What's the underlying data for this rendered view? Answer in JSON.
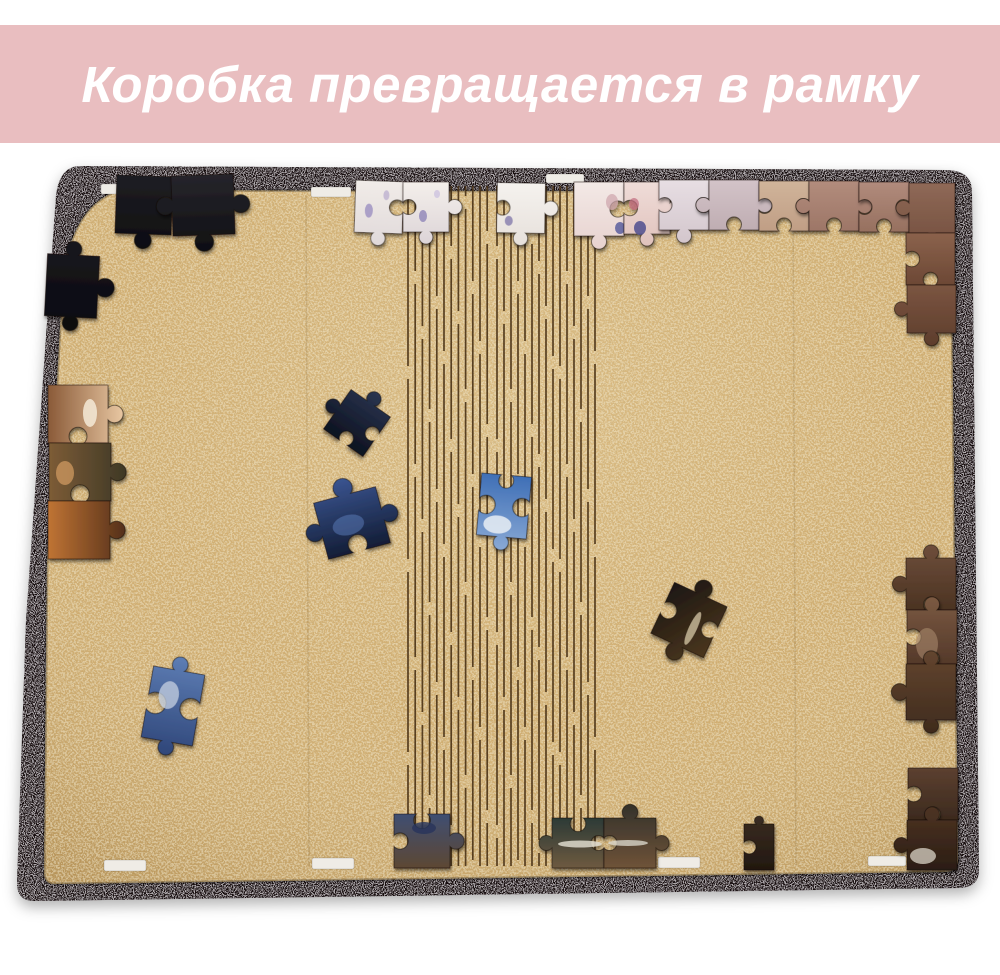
{
  "banner": {
    "text": "Коробка превращается в рамку",
    "bg_color": "#e9bec0",
    "text_color": "#ffffff"
  },
  "photo": {
    "frame": {
      "outer_path": "M 80 166 L 948 170 Q 972 171 972 192 L 979 868 Q 980 887 960 888 L 36 901 Q 17 902 17 883 L 26 620 L 56 195 Q 60 166 80 166 Z",
      "inner_path": "M 120 190 L 934 192 Q 951 193 951 207 L 958 860 Q 958 871 946 872 L 56 884 Q 44 885 44 872 L 47 560 L 62 292 Q 68 206 120 190 Z",
      "base_color": "#170e11",
      "speckle_color": "#9a9398",
      "edge_shadow": "rgba(0,0,0,0.25)"
    },
    "board": {
      "base_color": "#cfab6d",
      "speckle_light": "#eeddab",
      "speckle_dark": "#93713b",
      "glow_center": "#f7e7bd",
      "shade_edge": "#7a5620",
      "crease_xs": [
        306,
        793
      ]
    },
    "hinge": {
      "color": "#4a3216",
      "line_width": 1.7,
      "opacity": 0.9,
      "y_top": 186,
      "y_bottom": 866,
      "dash": "180 13",
      "offsets": [
        0,
        95,
        40,
        150,
        70,
        15,
        120,
        55,
        170,
        85,
        25,
        135,
        105,
        60,
        10
      ],
      "columns": [
        {
          "x_start": 408,
          "count": 12,
          "spacing": 7.2
        },
        {
          "x_start": 497,
          "count": 15,
          "spacing": 7.0
        }
      ]
    },
    "slots": {
      "color": "#efece6",
      "items": [
        {
          "x": 101,
          "y": 184,
          "w": 40,
          "h": 10
        },
        {
          "x": 311,
          "y": 187,
          "w": 40,
          "h": 10
        },
        {
          "x": 546,
          "y": 174,
          "w": 38,
          "h": 9
        },
        {
          "x": 104,
          "y": 860,
          "w": 42,
          "h": 11
        },
        {
          "x": 312,
          "y": 858,
          "w": 42,
          "h": 11
        },
        {
          "x": 658,
          "y": 857,
          "w": 42,
          "h": 11
        },
        {
          "x": 868,
          "y": 856,
          "w": 38,
          "h": 10
        }
      ]
    },
    "pieces": [
      {
        "name": "black-piece-top-left-a",
        "x": 116,
        "y": 176,
        "w": 56,
        "h": 58,
        "rot": 2,
        "tabs": [
          0,
          -1,
          1,
          0
        ],
        "colors": [
          "#1f1e23",
          "#0d0d11"
        ]
      },
      {
        "name": "black-piece-top-left-b",
        "x": 172,
        "y": 175,
        "w": 62,
        "h": 60,
        "rot": -2,
        "tabs": [
          0,
          1,
          1,
          1
        ],
        "colors": [
          "#26252b",
          "#0f0f13"
        ]
      },
      {
        "name": "floral-white-piece-a",
        "x": 355,
        "y": 181,
        "w": 48,
        "h": 52,
        "rot": 2,
        "tabs": [
          0,
          -1,
          1,
          0
        ],
        "colors": [
          "#f1ece8",
          "#e0d9da"
        ],
        "marks": [
          {
            "cx": 14,
            "cy": 30,
            "rx": 4,
            "ry": 7,
            "c": "#9b8fc0",
            "o": 0.8
          },
          {
            "cx": 31,
            "cy": 14,
            "rx": 3,
            "ry": 5,
            "c": "#b7aacd",
            "o": 0.7
          }
        ]
      },
      {
        "name": "floral-white-piece-b",
        "x": 403,
        "y": 182,
        "w": 46,
        "h": 50,
        "rot": 0,
        "tabs": [
          0,
          1,
          1,
          -1
        ],
        "colors": [
          "#f4efeb",
          "#dcd4d7"
        ],
        "marks": [
          {
            "cx": 20,
            "cy": 34,
            "rx": 4,
            "ry": 6,
            "c": "#8f84b8",
            "o": 0.8
          },
          {
            "cx": 34,
            "cy": 12,
            "rx": 3,
            "ry": 4,
            "c": "#c9bede",
            "o": 0.7
          }
        ]
      },
      {
        "name": "white-piece-top-center",
        "x": 497,
        "y": 183,
        "w": 48,
        "h": 50,
        "rot": 1,
        "tabs": [
          0,
          1,
          1,
          -1
        ],
        "colors": [
          "#f5f2ee",
          "#e6e0db"
        ],
        "marks": [
          {
            "cx": 12,
            "cy": 38,
            "rx": 4,
            "ry": 5,
            "c": "#7e74a8",
            "o": 0.75
          }
        ]
      },
      {
        "name": "pink-floral-piece-a",
        "x": 574,
        "y": 182,
        "w": 50,
        "h": 54,
        "rot": 0,
        "tabs": [
          0,
          -1,
          1,
          0
        ],
        "colors": [
          "#f3e9e6",
          "#e7d2cf"
        ],
        "marks": [
          {
            "cx": 38,
            "cy": 20,
            "rx": 6,
            "ry": 8,
            "c": "#cda4ab",
            "o": 0.7
          },
          {
            "cx": 46,
            "cy": 46,
            "rx": 5,
            "ry": 6,
            "c": "#5b5e9e",
            "o": 0.85
          }
        ]
      },
      {
        "name": "pink-floral-piece-b",
        "x": 624,
        "y": 182,
        "w": 46,
        "h": 52,
        "rot": 0,
        "tabs": [
          0,
          1,
          1,
          -1
        ],
        "colors": [
          "#efdcd8",
          "#e0c2bc"
        ],
        "marks": [
          {
            "cx": 16,
            "cy": 46,
            "rx": 6,
            "ry": 7,
            "c": "#4f4f8e",
            "o": 0.85
          },
          {
            "cx": 10,
            "cy": 22,
            "rx": 5,
            "ry": 6,
            "c": "#c06a7e",
            "o": 0.7
          }
        ]
      },
      {
        "name": "border-row-piece-1",
        "x": 659,
        "y": 180,
        "w": 50,
        "h": 50,
        "rot": 0,
        "tabs": [
          0,
          -1,
          1,
          -1
        ],
        "colors": [
          "#e7dee3",
          "#d3c6cc"
        ]
      },
      {
        "name": "border-row-piece-2",
        "x": 709,
        "y": 180,
        "w": 50,
        "h": 50,
        "rot": 0,
        "tabs": [
          0,
          1,
          -1,
          1
        ],
        "colors": [
          "#d3c3c8",
          "#bfadb2"
        ]
      },
      {
        "name": "border-row-piece-3",
        "x": 759,
        "y": 181,
        "w": 50,
        "h": 50,
        "rot": 0,
        "tabs": [
          0,
          -1,
          -1,
          -1
        ],
        "colors": [
          "#d0b49a",
          "#c09e85"
        ]
      },
      {
        "name": "border-row-piece-4",
        "x": 809,
        "y": 181,
        "w": 50,
        "h": 50,
        "rot": 0,
        "tabs": [
          0,
          1,
          -1,
          1
        ],
        "colors": [
          "#b28c7c",
          "#9d7667"
        ]
      },
      {
        "name": "border-row-piece-5",
        "x": 859,
        "y": 182,
        "w": 50,
        "h": 50,
        "rot": 0,
        "tabs": [
          0,
          -1,
          -1,
          -1
        ],
        "colors": [
          "#b18b7c",
          "#96705f"
        ]
      },
      {
        "name": "border-corner-piece",
        "x": 909,
        "y": 183,
        "w": 46,
        "h": 50,
        "rot": 0,
        "tabs": [
          0,
          0,
          1,
          1
        ],
        "colors": [
          "#8f6957",
          "#74503f"
        ]
      },
      {
        "name": "border-right-piece-1",
        "x": 906,
        "y": 233,
        "w": 49,
        "h": 52,
        "rot": 0,
        "tabs": [
          0,
          0,
          -1,
          -1
        ],
        "colors": [
          "#8b624c",
          "#6c4835"
        ]
      },
      {
        "name": "border-right-piece-2",
        "x": 907,
        "y": 285,
        "w": 49,
        "h": 48,
        "rot": 0,
        "tabs": [
          0,
          0,
          1,
          1
        ],
        "colors": [
          "#7b5541",
          "#5d3d2c"
        ]
      },
      {
        "name": "dark-piece-left-edge",
        "x": 46,
        "y": 255,
        "w": 52,
        "h": 62,
        "rot": 3,
        "tabs": [
          1,
          1,
          1,
          0
        ],
        "colors": [
          "#18171e",
          "#0a0a0f"
        ]
      },
      {
        "name": "art-strip-piece-a",
        "x": 48,
        "y": 385,
        "w": 60,
        "h": 58,
        "rot": 0,
        "tabs": [
          0,
          1,
          -1,
          0
        ],
        "angle": "h",
        "colors": [
          "#8a5a38",
          "#e8c7a2"
        ],
        "marks": [
          {
            "cx": 42,
            "cy": 28,
            "rx": 7,
            "ry": 14,
            "c": "#f5ead7",
            "o": 0.85
          }
        ]
      },
      {
        "name": "art-strip-piece-b",
        "x": 49,
        "y": 443,
        "w": 62,
        "h": 58,
        "rot": 0,
        "tabs": [
          0,
          1,
          -1,
          0
        ],
        "angle": "h",
        "colors": [
          "#7d5c36",
          "#3e3826"
        ],
        "marks": [
          {
            "cx": 16,
            "cy": 30,
            "rx": 9,
            "ry": 12,
            "c": "#c9955c",
            "o": 0.8
          }
        ]
      },
      {
        "name": "art-strip-piece-c",
        "x": 48,
        "y": 501,
        "w": 62,
        "h": 58,
        "rot": 0,
        "tabs": [
          0,
          1,
          0,
          0
        ],
        "angle": "h",
        "colors": [
          "#c07434",
          "#54301a"
        ]
      },
      {
        "name": "navy-piece-small",
        "x": 333,
        "y": 399,
        "w": 48,
        "h": 48,
        "rot": 35,
        "tabs": [
          1,
          -1,
          -1,
          1
        ],
        "colors": [
          "#2a3550",
          "#0d1220"
        ]
      },
      {
        "name": "navy-piece-large",
        "x": 320,
        "y": 494,
        "w": 64,
        "h": 58,
        "rot": -15,
        "tabs": [
          1,
          1,
          -1,
          1
        ],
        "colors": [
          "#3a5490",
          "#131d36"
        ],
        "marks": [
          {
            "cx": 28,
            "cy": 30,
            "rx": 16,
            "ry": 10,
            "c": "#5d7fbe",
            "o": 0.5
          }
        ]
      },
      {
        "name": "sky-piece-center",
        "x": 479,
        "y": 475,
        "w": 50,
        "h": 62,
        "rot": 5,
        "tabs": [
          -1,
          -1,
          1,
          -1
        ],
        "colors": [
          "#3f6fb6",
          "#89a9d5"
        ],
        "marks": [
          {
            "cx": 20,
            "cy": 50,
            "rx": 14,
            "ry": 9,
            "c": "#e9eef5",
            "o": 0.85
          }
        ]
      },
      {
        "name": "dark-piece-mid-right",
        "x": 660,
        "y": 592,
        "w": 58,
        "h": 56,
        "rot": 25,
        "tabs": [
          1,
          -1,
          1,
          -1
        ],
        "angle": "d",
        "colors": [
          "#171310",
          "#503a20"
        ],
        "marks": [
          {
            "cx": 36,
            "cy": 34,
            "rx": 4,
            "ry": 18,
            "c": "#d8c9a8",
            "o": 0.75
          }
        ]
      },
      {
        "name": "blue-piece-bottom-left",
        "x": 147,
        "y": 670,
        "w": 52,
        "h": 72,
        "rot": 10,
        "tabs": [
          1,
          -1,
          1,
          -1
        ],
        "colors": [
          "#5d7db4",
          "#2f4679"
        ],
        "marks": [
          {
            "cx": 20,
            "cy": 26,
            "rx": 10,
            "ry": 14,
            "c": "#c7d2e2",
            "o": 0.75
          }
        ]
      },
      {
        "name": "dark-piece-bottom-a",
        "x": 394,
        "y": 814,
        "w": 56,
        "h": 54,
        "rot": 0,
        "tabs": [
          -1,
          1,
          0,
          -1
        ],
        "colors": [
          "#3f4f72",
          "#5d4733"
        ],
        "marks": [
          {
            "cx": 30,
            "cy": 14,
            "rx": 12,
            "ry": 6,
            "c": "#27355a",
            "o": 0.8
          }
        ]
      },
      {
        "name": "dark-piece-bottom-b1",
        "x": 552,
        "y": 818,
        "w": 52,
        "h": 50,
        "rot": 0,
        "tabs": [
          -1,
          -1,
          0,
          1
        ],
        "colors": [
          "#2c3a36",
          "#6e5a40"
        ],
        "marks": [
          {
            "cx": 28,
            "cy": 26,
            "rx": 22,
            "ry": 3.5,
            "c": "#ddd9cd",
            "o": 0.85
          }
        ]
      },
      {
        "name": "dark-piece-bottom-b2",
        "x": 604,
        "y": 818,
        "w": 52,
        "h": 50,
        "rot": 0,
        "tabs": [
          1,
          1,
          0,
          -1
        ],
        "colors": [
          "#33312b",
          "#6f5338"
        ],
        "marks": [
          {
            "cx": 24,
            "cy": 25,
            "rx": 20,
            "ry": 3,
            "c": "#d8d4c8",
            "o": 0.8
          }
        ]
      },
      {
        "name": "piece-bottom-right-sliver",
        "x": 744,
        "y": 824,
        "w": 30,
        "h": 46,
        "rot": 0,
        "tabs": [
          1,
          0,
          0,
          -1
        ],
        "colors": [
          "#3a2c22",
          "#22180f"
        ]
      },
      {
        "name": "right-edge-piece-1",
        "x": 906,
        "y": 558,
        "w": 50,
        "h": 52,
        "rot": 0,
        "tabs": [
          1,
          0,
          -1,
          1
        ],
        "colors": [
          "#6e4e3b",
          "#4b3322"
        ]
      },
      {
        "name": "right-edge-piece-2",
        "x": 907,
        "y": 610,
        "w": 50,
        "h": 54,
        "rot": 0,
        "tabs": [
          1,
          0,
          -1,
          -1
        ],
        "colors": [
          "#7b5a42",
          "#54392a"
        ],
        "marks": [
          {
            "cx": 20,
            "cy": 34,
            "rx": 11,
            "ry": 16,
            "c": "#a8896d",
            "o": 0.6
          }
        ]
      },
      {
        "name": "right-edge-piece-3",
        "x": 906,
        "y": 664,
        "w": 50,
        "h": 56,
        "rot": 0,
        "tabs": [
          1,
          0,
          1,
          1
        ],
        "colors": [
          "#63452f",
          "#3f2b1d"
        ]
      },
      {
        "name": "right-edge-piece-4",
        "x": 908,
        "y": 768,
        "w": 50,
        "h": 52,
        "rot": 0,
        "tabs": [
          0,
          0,
          -1,
          -1
        ],
        "colors": [
          "#5c4030",
          "#3c2a1e"
        ]
      },
      {
        "name": "right-edge-piece-5",
        "x": 907,
        "y": 820,
        "w": 50,
        "h": 50,
        "rot": 0,
        "tabs": [
          1,
          0,
          0,
          1
        ],
        "colors": [
          "#4e3423",
          "#2b1d14"
        ],
        "marks": [
          {
            "cx": 16,
            "cy": 36,
            "rx": 13,
            "ry": 8,
            "c": "#cfc8bb",
            "o": 0.8
          }
        ]
      }
    ]
  }
}
